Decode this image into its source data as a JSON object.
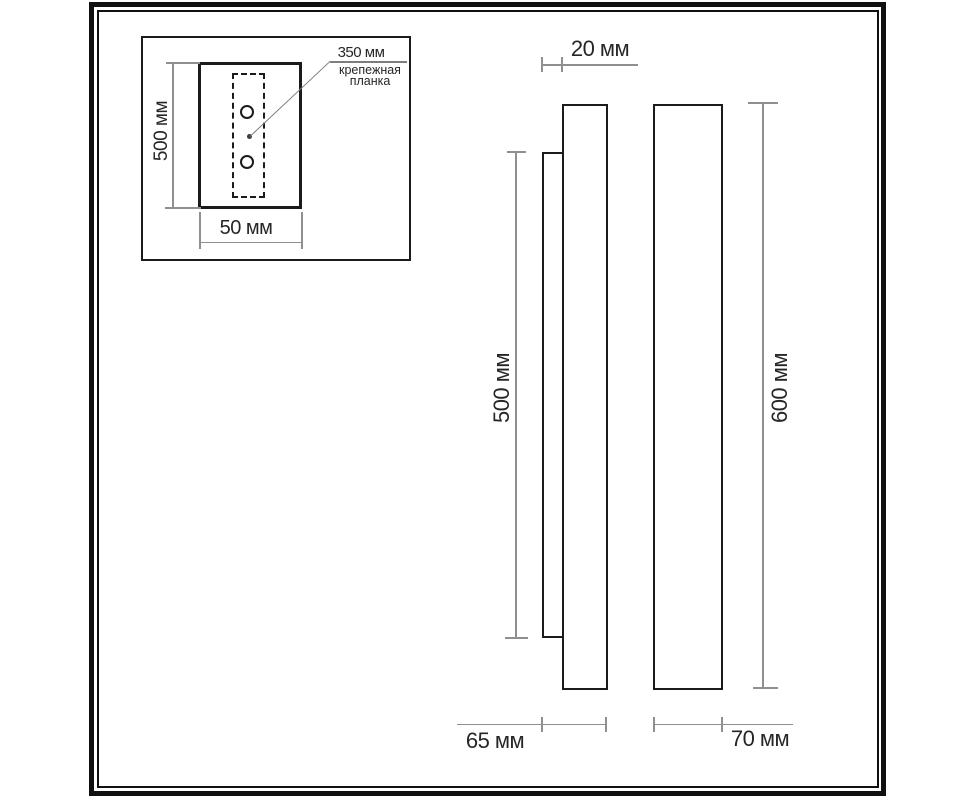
{
  "colors": {
    "bg": "#ffffff",
    "frame": "#101010",
    "stroke": "#1b1b1b",
    "dim": "#8f8f8f",
    "text": "#262626"
  },
  "inset": {
    "leader": {
      "value": "350 мм",
      "caption_line1": "крепежная",
      "caption_line2": "планка"
    },
    "height_label": "500 мм",
    "width_label": "50 мм"
  },
  "side_view": {
    "plate_depth_label": "20 мм",
    "plate_height_label": "500 мм",
    "total_depth_label": "65 мм"
  },
  "front_view": {
    "height_label": "600 мм",
    "width_label": "70 мм"
  }
}
